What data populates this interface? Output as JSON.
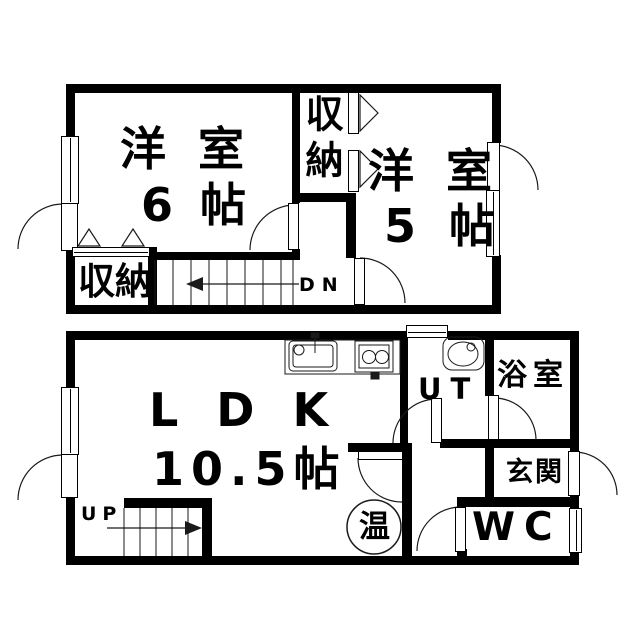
{
  "colors": {
    "wall": "#000000",
    "background": "#ffffff",
    "line": "#1a1a1a"
  },
  "floor2": {
    "room6": {
      "name": "洋室",
      "size": "6帖"
    },
    "closet_top": "収納",
    "room5": {
      "name": "洋室",
      "size": "5帖"
    },
    "closet_bottom": "収納",
    "stairs": "DN"
  },
  "floor1": {
    "ldk": {
      "name": "LDK",
      "size": "10.5帖"
    },
    "utility": "UT",
    "bath": "浴室",
    "entrance": "玄関",
    "toilet": "WC",
    "water_heater": "温",
    "stairs": "UP"
  }
}
